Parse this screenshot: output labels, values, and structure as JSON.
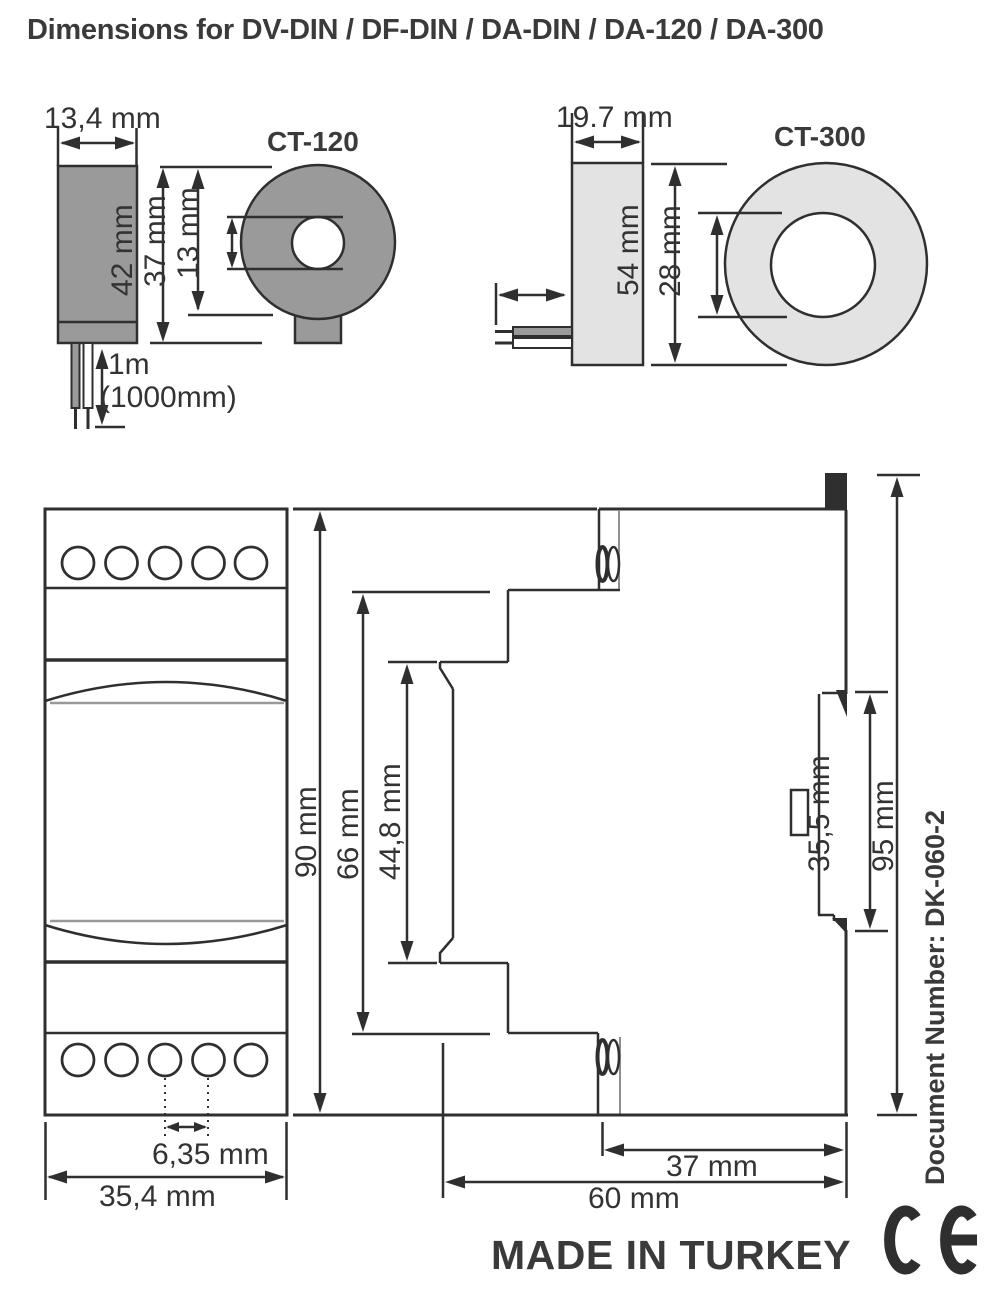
{
  "page_title": "Dimensions for DV-DIN / DF-DIN / DA-DIN / DA-120 / DA-300",
  "ct120": {
    "title": "CT-120",
    "width": "13,4 mm",
    "overall_height": "42 mm",
    "body_height": "37 mm",
    "hole_diameter": "13 mm",
    "cable_length": "1m",
    "cable_length_mm": "(1000mm)"
  },
  "ct300": {
    "title": "CT-300",
    "width": "19.7 mm",
    "overall_height": "54 mm",
    "hole_diameter": "28 mm"
  },
  "module_front": {
    "height": "90 mm",
    "terminal_pitch": "6,35 mm",
    "width": "35,4 mm"
  },
  "module_side": {
    "inner_height": "66 mm",
    "window_height": "44,8 mm",
    "din_recess_height": "35,5 mm",
    "total_height": "95 mm",
    "rear_depth": "37 mm",
    "total_depth": "60 mm"
  },
  "footer": {
    "made_in": "MADE IN TURKEY",
    "document_number": "Document Number: DK-060-2",
    "ce_mark": "CE"
  },
  "colors": {
    "line": "#2f2f2f",
    "text": "#333333",
    "heading": "#3a3a3a",
    "ct120_fill": "#9a9a9a",
    "ct300_fill": "#e3e3e3",
    "window_line": "#999999"
  }
}
